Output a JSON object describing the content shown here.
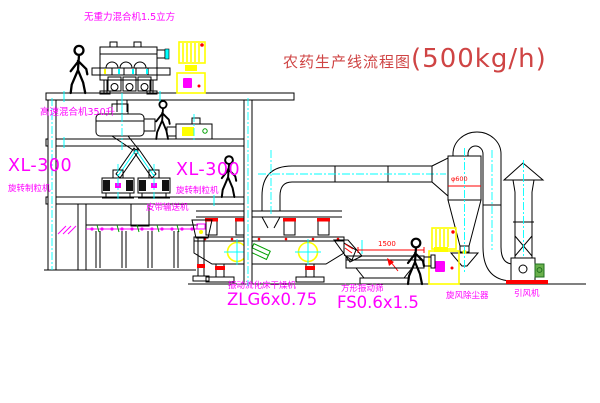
{
  "title": {
    "text_cn": "农药生产线流程图",
    "capacity": "(500kg/h)"
  },
  "equipment_labels": {
    "gravity_mixer": "无重力混合机1.5立方",
    "high_speed_mixer": "高速混合机350升",
    "granulator_left_model": "XL-300",
    "granulator_left_name": "旋转制粒机",
    "granulator_right_model": "XL-300",
    "granulator_right_name": "旋转制粒机",
    "belt_conveyor": "皮带输送机",
    "dryer_name": "振动流化床干燥机",
    "dryer_model": "ZLG6x0.75",
    "sieve_name": "方形振动筛",
    "sieve_model": "FS0.6x1.5",
    "cyclone": "旋风除尘器",
    "fan": "引风机"
  },
  "dimensions": {
    "sieve_width": "1500",
    "cyclone_diameter": "φ600"
  },
  "colors": {
    "label_magenta": "#ff00ff",
    "title_red": "#cf4444",
    "dimension_red": "#ff0000",
    "line_black": "#000000",
    "centerline_cyan": "#00ffff",
    "equipment_yellow": "#ffff00",
    "detail_green": "#00a000",
    "background": "#ffffff"
  }
}
